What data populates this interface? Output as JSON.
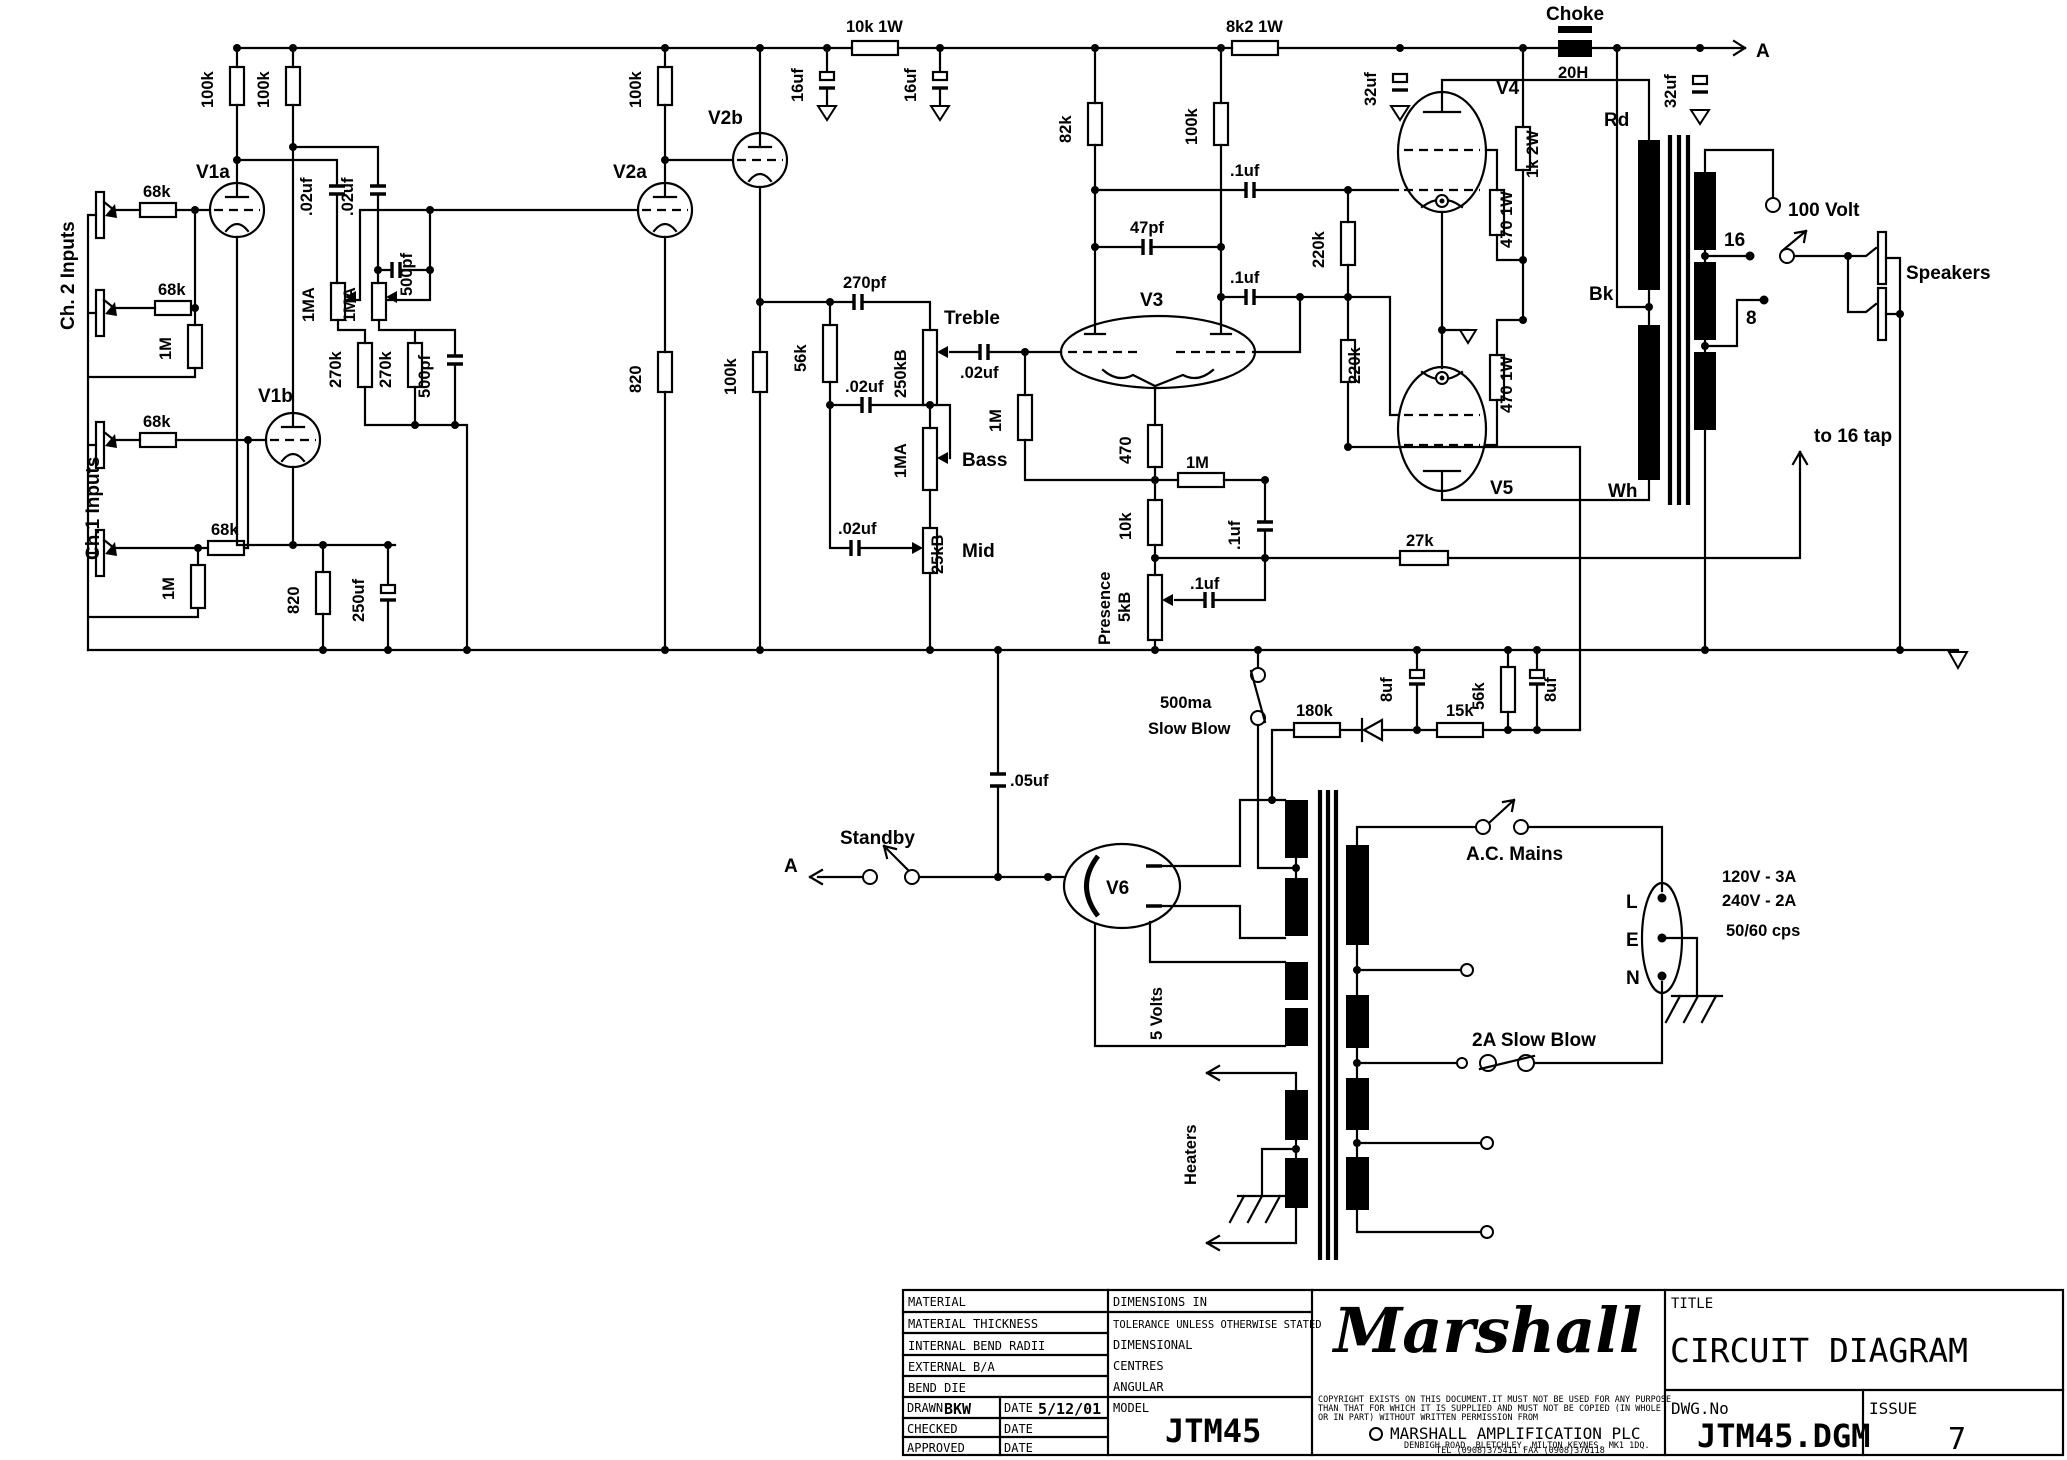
{
  "diagram": {
    "inputs": {
      "ch2": "Ch. 2 Inputs",
      "ch1": "Ch.1 Inputs",
      "r68k_1": "68k",
      "r68k_2": "68k",
      "r68k_3": "68k",
      "r68k_4": "68k",
      "r1m_a": "1M",
      "r1m_b": "1M"
    },
    "preamp": {
      "v1a": "V1a",
      "v1b": "V1b",
      "v2a": "V2a",
      "v2b": "V2b",
      "r_plate_v1a": "100k",
      "r_plate_v1b": "100k",
      "r_plate_v2a": "100k",
      "r_cath_v2b": "100k",
      "c_couple_a": ".02uf",
      "c_couple_b": ".02uf",
      "pot_vol_a": "1MA",
      "pot_vol_b": "1MA",
      "r_mix_a": "270k",
      "r_mix_b": "270k",
      "c_bright_a": "500pf",
      "c_bright_b": "500pf",
      "r_cath_v1": "820",
      "c_cath_v1": "250uf",
      "r_cath_v2a": "820"
    },
    "rail": {
      "r_drop1": "10k 1W",
      "r_drop2": "8k2 1W",
      "c_16uf_a": "16uf",
      "c_16uf_b": "16uf",
      "c_32uf_a": "32uf",
      "c_32uf_b": "32uf",
      "choke": "Choke",
      "choke_h": "20H",
      "a_link": "A"
    },
    "tone": {
      "c_270pf": "270pf",
      "r_56k": "56k",
      "pot_treble": "250kB",
      "treble": "Treble",
      "c_slope": ".02uf",
      "c_mid": ".02uf",
      "c_out": ".02uf",
      "pot_bass": "1MA",
      "bass": "Bass",
      "pot_mid": "25kB",
      "mid": "Mid"
    },
    "pi": {
      "v3": "V3",
      "r_82k": "82k",
      "r_100k": "100k",
      "c_47pf": "47pf",
      "c_out1": ".1uf",
      "c_out2": ".1uf",
      "r_grid_1m": "1M",
      "r_tail_470": "470",
      "r_tail_1m": "1M",
      "r_tail_10k": "10k",
      "c_tail": ".1uf",
      "presence": "Presence",
      "pot_presence": "5kB",
      "c_presence": ".1uf",
      "r_nfb": "27k",
      "nfb_note": "to 16 tap"
    },
    "power": {
      "v4": "V4",
      "v5": "V5",
      "r_220k_a": "220k",
      "r_220k_b": "220k",
      "r_470_a": "470 1W",
      "r_470_b": "470 1W",
      "r_screen": "1k 2W"
    },
    "ot": {
      "rd": "Rd",
      "bk": "Bk",
      "wh": "Wh",
      "tap100": "100 Volt",
      "tap16": "16",
      "tap8": "8",
      "speakers": "Speakers"
    },
    "psu": {
      "v6": "V6",
      "standby": "Standby",
      "a_link": "A",
      "c_standby": ".05uf",
      "fuse1": "500ma",
      "fuse2": "Slow Blow",
      "w_5v": "5 Volts",
      "w_heaters": "Heaters"
    },
    "bias": {
      "r_180k": "180k",
      "r_15k": "15k",
      "r_56k": "56k",
      "c_8uf_a": "8uf",
      "c_8uf_b": "8uf"
    },
    "mains": {
      "switch": "A.C. Mains",
      "fuse": "2A Slow Blow",
      "rating1": "120V - 3A",
      "rating2": "240V - 2A",
      "rating3": "50/60 cps",
      "pin_l": "L",
      "pin_e": "E",
      "pin_n": "N"
    }
  },
  "title_block": {
    "material": "MATERIAL",
    "material_thickness": "MATERIAL THICKNESS",
    "internal_bend": "INTERNAL BEND RADII",
    "external_ba": "EXTERNAL B/A",
    "bend_die": "BEND DIE",
    "drawn": "DRAWN",
    "drawn_by": "BKW",
    "date_label1": "DATE",
    "drawn_date": "5/12/01",
    "checked": "CHECKED",
    "date_label2": "DATE",
    "approved": "APPROVED",
    "date_label3": "DATE",
    "dims": "DIMENSIONS IN",
    "tolerance": "TOLERANCE UNLESS OTHERWISE STATED",
    "dimensional": "DIMENSIONAL",
    "centres": "CENTRES",
    "angular": "ANGULAR",
    "model_label": "MODEL",
    "model": "JTM45",
    "logo": "Marshall",
    "copy1": "COPYRIGHT EXISTS ON THIS DOCUMENT.IT MUST NOT BE USED FOR ANY PURPOSE",
    "copy2": "THAN THAT FOR WHICH IT IS SUPPLIED AND MUST NOT BE COPIED (IN WHOLE",
    "copy3": "OR IN PART) WITHOUT WRITTEN PERMISSION FROM",
    "company": "MARSHALL AMPLIFICATION PLC",
    "address": "DENBIGH ROAD, BLETCHLEY, MILTON KEYNES, MK1 1DQ.",
    "tel": "TEL (0908)375411 FAX (0908)376118",
    "title_label": "TITLE",
    "title": "CIRCUIT DIAGRAM",
    "dwg_label": "DWG.No",
    "dwg": "JTM45.DGM",
    "issue_label": "ISSUE",
    "issue": "7"
  }
}
